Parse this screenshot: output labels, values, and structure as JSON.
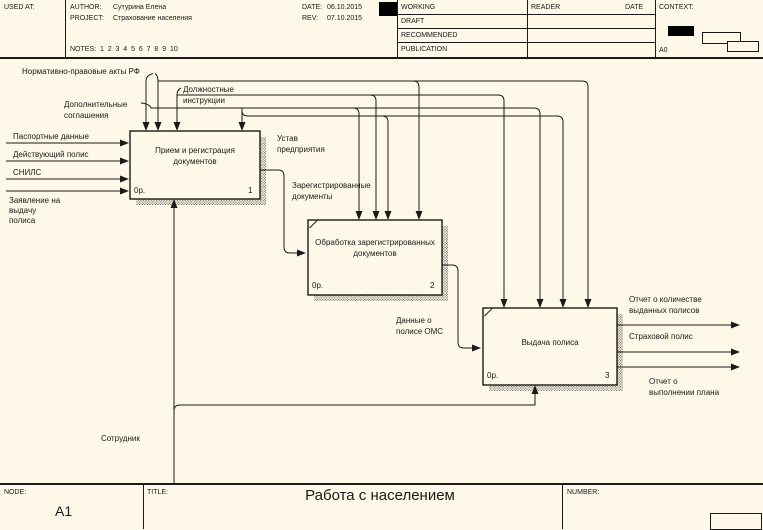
{
  "colors": {
    "background": "#FDF8E7",
    "line": "#1A1A1A"
  },
  "header": {
    "used_at": "USED AT:",
    "author_label": "AUTHOR:",
    "author": "Сутурина Елена",
    "project_label": "PROJECT:",
    "project": "Страхование населения",
    "date_label": "DATE:",
    "date": "06.10.2015",
    "rev_label": "REV:",
    "rev": "07.10.2015",
    "notes": "NOTES:  1  2  3  4  5  6  7  8  9  10",
    "status_rows": [
      "WORKING",
      "DRAFT",
      "RECOMMENDED",
      "PUBLICATION"
    ],
    "reader_label": "READER",
    "date_col_label": "DATE",
    "context_label": "CONTEXT:",
    "context_node": "A0"
  },
  "diagram": {
    "boxes": [
      {
        "title": "Прием и регистрация\nдокументов",
        "cost": "0р.",
        "number": "1"
      },
      {
        "title": "Обработка зарегистрированных\nдокументов",
        "cost": "0р.",
        "number": "2"
      },
      {
        "title": "Выдача полиса",
        "cost": "0р.",
        "number": "3"
      }
    ],
    "labels": {
      "normative_acts": "Нормативно-правовые акты РФ",
      "additional_agreements": "Дополнительные\nсоглашения",
      "job_instructions": "Должностные\nинструкции",
      "company_charter": "Устав\nпредприятия",
      "passport_data": "Паспортные данные",
      "active_policy": "Действующий полис",
      "snils": "СНИЛС",
      "application": "Заявление на\nвыдачу\nполиса",
      "registered_docs": "Зарегистрированные\nдокументы",
      "oms_policy_data": "Данные о\nполисе ОМС",
      "report_issued_count": "Отчет о количестве\nвыданных полисов",
      "insurance_policy": "Страховой полис",
      "report_plan": "Отчет о\nвыполнении плана",
      "employee": "Сотрудник"
    }
  },
  "footer": {
    "node_label": "NODE:",
    "node": "A1",
    "title_label": "TITLE:",
    "title": "Работа с населением",
    "number_label": "NUMBER:"
  }
}
